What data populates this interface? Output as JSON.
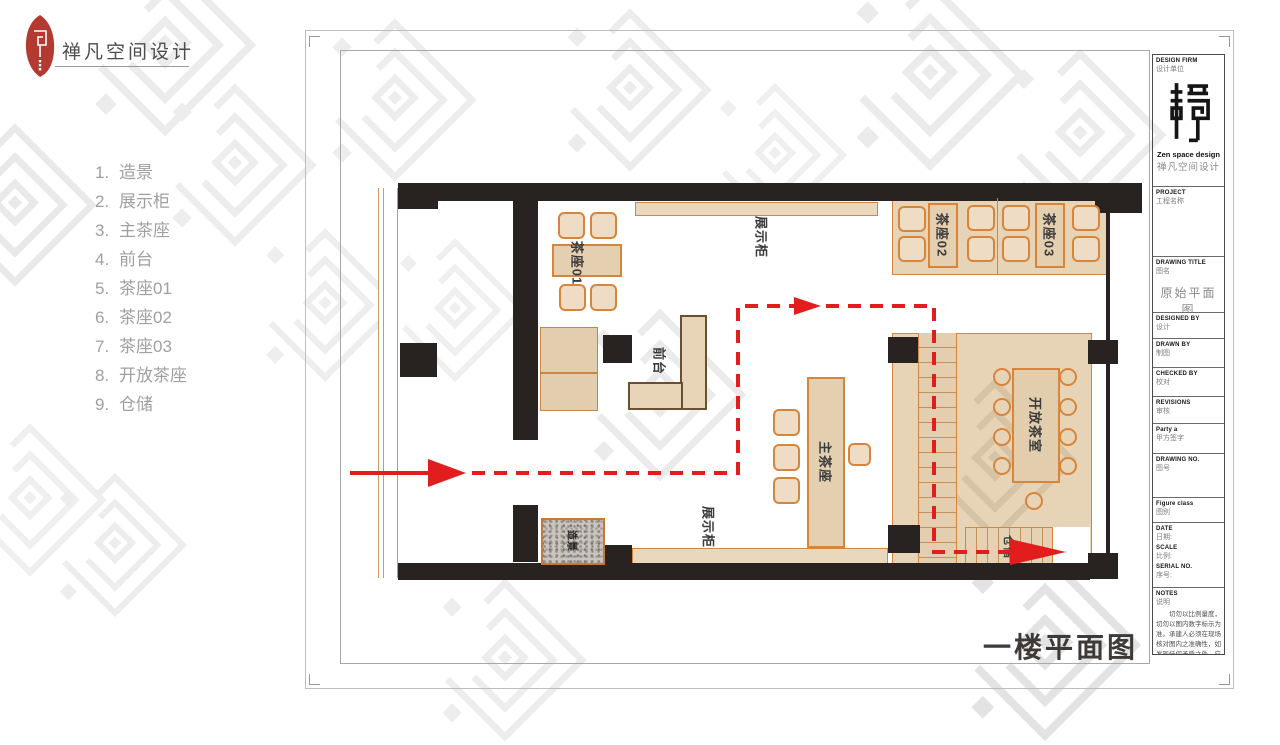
{
  "header": {
    "brand": "禅凡空间设计"
  },
  "legend": {
    "items": [
      {
        "num": "1.",
        "label": "造景"
      },
      {
        "num": "2.",
        "label": "展示柜"
      },
      {
        "num": "3.",
        "label": "主茶座"
      },
      {
        "num": "4.",
        "label": "前台"
      },
      {
        "num": "5.",
        "label": "茶座01"
      },
      {
        "num": "6.",
        "label": "茶座02"
      },
      {
        "num": "7.",
        "label": "茶座03"
      },
      {
        "num": "8.",
        "label": "开放茶座"
      },
      {
        "num": "9.",
        "label": "仓储"
      }
    ]
  },
  "plan": {
    "caption": "一楼平面图",
    "labels": {
      "tea01": "茶座01",
      "tea02": "茶座02",
      "tea03": "茶座03",
      "display_top": "展示柜",
      "display_bottom": "展示柜",
      "front_desk": "前台",
      "main_tea": "主茶座",
      "open_tea": "开放茶室",
      "storage": "仓储",
      "landscape": "造景"
    }
  },
  "titleblock": {
    "design_firm_en": "DESIGN FIRM",
    "design_firm_zh": "设计单位",
    "brand_en": "Zen space design",
    "brand_zh": "禅凡空间设计",
    "project_en": "PROJECT",
    "project_zh": "工程名称",
    "drawing_title_en": "DRAWING TITLE",
    "drawing_title_zh": "图名",
    "drawing_title_value": "原始平面图",
    "designed_by_en": "DESIGNED BY",
    "designed_by_zh": "设计",
    "drawn_by_en": "DRAWN BY",
    "drawn_by_zh": "制图",
    "checked_by_en": "CHECKED BY",
    "checked_by_zh": "校对",
    "revisions_en": "REVISIONS",
    "revisions_zh": "审核",
    "party_a_en": "Party a",
    "party_a_zh": "甲方签字",
    "drawing_no_en": "DRAWING NO.",
    "drawing_no_zh": "图号",
    "figure_class_en": "Figure class",
    "figure_class_zh": "图别",
    "date_en": "DATE",
    "date_zh": "日期:",
    "scale_en": "SCALE",
    "scale_zh": "比例:",
    "serial_no_en": "SERIAL NO.",
    "serial_no_zh": "序号:",
    "notes_en": "NOTES",
    "notes_zh": "说明",
    "notes_text": "切勿以比例量度，切勿以图内数字标示为准。承建人必须在现场核对图内之准确性，如发现任何矛盾之处，应立即通知设计师。"
  },
  "icons": {
    "header_logo": "red-leaf-zen-logo",
    "titleblock_logo": "zen-maze-logo",
    "watermark": "zen-diamond-watermark",
    "flow_arrows": "red-dashed-circulation-arrows"
  },
  "colors": {
    "accent_red": "#e21d1d",
    "wall": "#282321",
    "furniture_outline": "#d8853c",
    "furniture_fill": "#ead8bd",
    "logo_red": "#b23a31"
  }
}
